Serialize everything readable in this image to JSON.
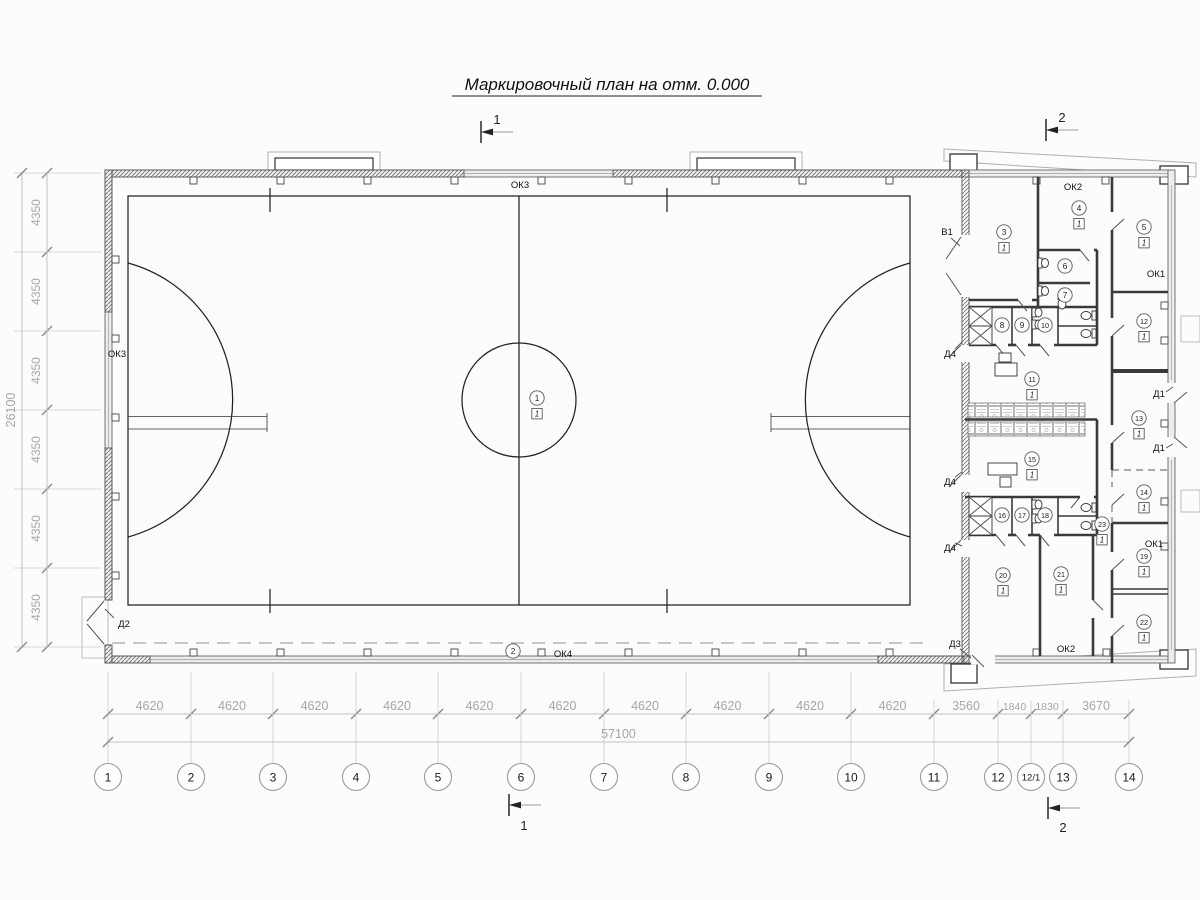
{
  "title": "Маркировочный план на отм. 0.000",
  "sections": {
    "top1": "1",
    "top2": "2",
    "bot1": "1",
    "bot2": "2"
  },
  "grid_bottom": {
    "bubbles": [
      {
        "label": "1",
        "x": 108
      },
      {
        "label": "2",
        "x": 191
      },
      {
        "label": "3",
        "x": 273
      },
      {
        "label": "4",
        "x": 356
      },
      {
        "label": "5",
        "x": 438
      },
      {
        "label": "6",
        "x": 521
      },
      {
        "label": "7",
        "x": 604
      },
      {
        "label": "8",
        "x": 686
      },
      {
        "label": "9",
        "x": 769
      },
      {
        "label": "10",
        "x": 851
      },
      {
        "label": "11",
        "x": 934
      },
      {
        "label": "12",
        "x": 998
      },
      {
        "label": "12/1",
        "x": 1031
      },
      {
        "label": "13",
        "x": 1063
      },
      {
        "label": "14",
        "x": 1129
      }
    ],
    "dims": [
      "4620",
      "4620",
      "4620",
      "4620",
      "4620",
      "4620",
      "4620",
      "4620",
      "4620",
      "4620",
      "3560",
      "1840",
      "1830",
      "3670"
    ],
    "total": "57100"
  },
  "grid_left": {
    "ys": [
      173,
      252,
      331,
      410,
      489,
      568,
      647
    ],
    "dims": [
      "4350",
      "4350",
      "4350",
      "4350",
      "4350",
      "4350"
    ],
    "total": "26100"
  },
  "rooms": [
    {
      "n": "1",
      "f": "1",
      "x": 537,
      "y": 398
    },
    {
      "n": "2",
      "x": 513,
      "y": 651
    },
    {
      "n": "3",
      "f": "1",
      "x": 1004,
      "y": 232
    },
    {
      "n": "4",
      "f": "1",
      "x": 1079,
      "y": 208
    },
    {
      "n": "5",
      "f": "1",
      "x": 1144,
      "y": 227
    },
    {
      "n": "6",
      "x": 1065,
      "y": 266
    },
    {
      "n": "7",
      "x": 1065,
      "y": 295
    },
    {
      "n": "8",
      "x": 1002,
      "y": 325
    },
    {
      "n": "9",
      "x": 1022,
      "y": 325
    },
    {
      "n": "10",
      "x": 1045,
      "y": 325
    },
    {
      "n": "11",
      "f": "1",
      "x": 1032,
      "y": 379
    },
    {
      "n": "12",
      "f": "1",
      "x": 1144,
      "y": 321
    },
    {
      "n": "13",
      "f": "1",
      "x": 1139,
      "y": 418
    },
    {
      "n": "14",
      "f": "1",
      "x": 1144,
      "y": 492
    },
    {
      "n": "15",
      "f": "1",
      "x": 1032,
      "y": 459
    },
    {
      "n": "16",
      "x": 1002,
      "y": 515
    },
    {
      "n": "17",
      "x": 1022,
      "y": 515
    },
    {
      "n": "18",
      "x": 1045,
      "y": 515
    },
    {
      "n": "19",
      "f": "1",
      "x": 1144,
      "y": 556
    },
    {
      "n": "20",
      "f": "1",
      "x": 1003,
      "y": 575
    },
    {
      "n": "21",
      "f": "1",
      "x": 1061,
      "y": 574
    },
    {
      "n": "22",
      "f": "1",
      "x": 1144,
      "y": 622
    },
    {
      "n": "23",
      "f": "1",
      "x": 1102,
      "y": 524
    }
  ],
  "labels": [
    {
      "t": "ОК3",
      "x": 520,
      "y": 188
    },
    {
      "t": "ОК3",
      "x": 117,
      "y": 357
    },
    {
      "t": "ОК4",
      "x": 563,
      "y": 657
    },
    {
      "t": "ОК2",
      "x": 1073,
      "y": 190
    },
    {
      "t": "ОК2",
      "x": 1066,
      "y": 652
    },
    {
      "t": "ОК1",
      "x": 1156,
      "y": 277
    },
    {
      "t": "ОК1",
      "x": 1154,
      "y": 547
    },
    {
      "t": "В1",
      "x": 947,
      "y": 235
    },
    {
      "t": "Д2",
      "x": 124,
      "y": 627
    },
    {
      "t": "Д4",
      "x": 950,
      "y": 357
    },
    {
      "t": "Д4",
      "x": 950,
      "y": 485
    },
    {
      "t": "Д4",
      "x": 950,
      "y": 551
    },
    {
      "t": "Д3",
      "x": 955,
      "y": 647
    },
    {
      "t": "Д1",
      "x": 1159,
      "y": 397
    },
    {
      "t": "Д1",
      "x": 1159,
      "y": 451
    }
  ]
}
